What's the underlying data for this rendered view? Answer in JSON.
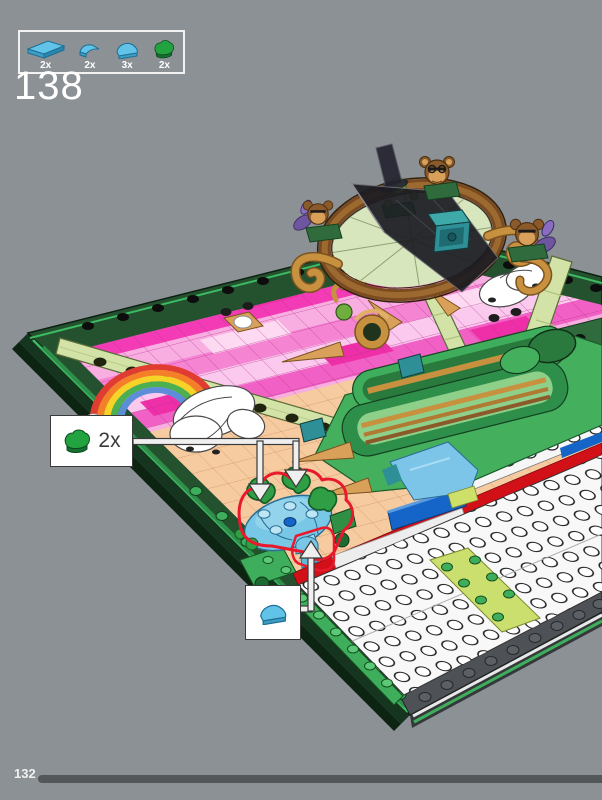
{
  "step": {
    "number": "138"
  },
  "parts_box": {
    "items": [
      {
        "icon": "tile-1x2-azure-icon",
        "count": "2x"
      },
      {
        "icon": "quarter-tile-azure-icon",
        "count": "2x"
      },
      {
        "icon": "half-round-tile-azure-icon",
        "count": "3x"
      },
      {
        "icon": "heart-tile-green-icon",
        "count": "2x"
      }
    ]
  },
  "callouts": [
    {
      "icon": "heart-tile-green-icon",
      "count": "2x"
    },
    {
      "icon": "half-round-tile-azure-icon",
      "count": ""
    }
  ],
  "footer": {
    "page_number": "132"
  },
  "colors": {
    "background": "#8b9194",
    "frame_green_dark": "#24522f",
    "frame_green_bright": "#3dbb63",
    "mosaic_pink_hot": "#f23bb5",
    "mosaic_pink_light": "#f9aee2",
    "poppy_peach": "#f7cba0",
    "azure_part": "#62c3e8",
    "green_part": "#2f9e44",
    "highlight_red": "#e8192c",
    "progress_bar": "#53575a"
  }
}
